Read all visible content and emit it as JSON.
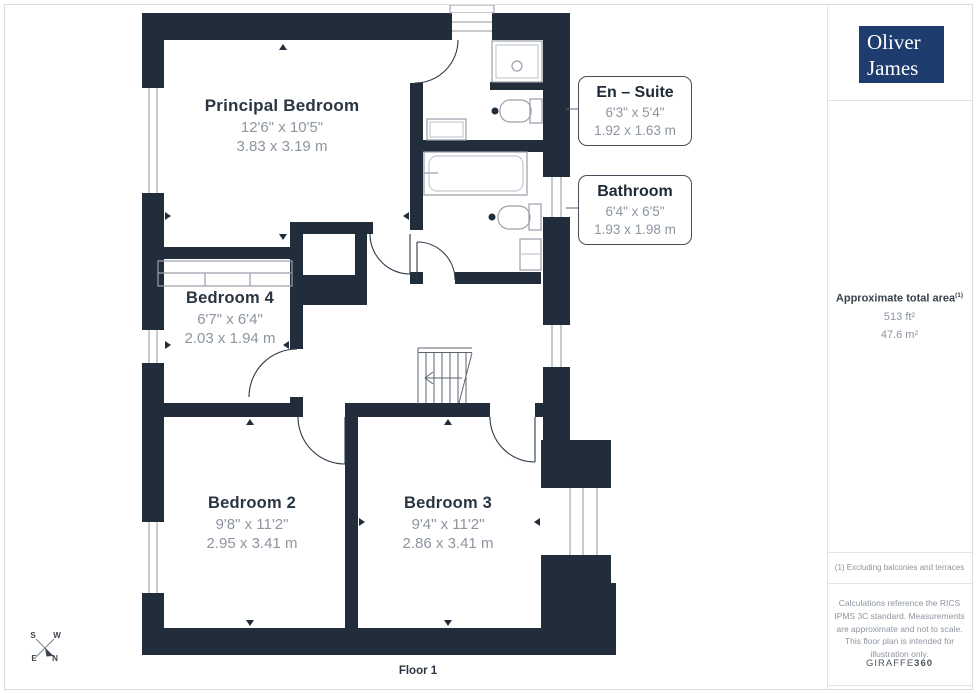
{
  "plan": {
    "floor_label": "Floor 1",
    "rooms": [
      {
        "name": "Principal Bedroom",
        "imperial": "12'6\" x 10'5\"",
        "metric": "3.83 x 3.19 m"
      },
      {
        "name": "Bedroom 4",
        "imperial": "6'7\" x 6'4\"",
        "metric": "2.03 x 1.94 m"
      },
      {
        "name": "Bedroom 2",
        "imperial": "9'8\" x 11'2\"",
        "metric": "2.95 x 3.41 m"
      },
      {
        "name": "Bedroom 3",
        "imperial": "9'4\" x 11'2\"",
        "metric": "2.86 x 3.41 m"
      }
    ],
    "callouts": [
      {
        "name": "En – Suite",
        "imperial": "6'3\" x 5'4\"",
        "metric": "1.92 x 1.63 m"
      },
      {
        "name": "Bathroom",
        "imperial": "6'4\" x 6'5\"",
        "metric": "1.93 x 1.98 m"
      }
    ],
    "compass": {
      "n": "N",
      "s": "S",
      "e": "E",
      "w": "W"
    }
  },
  "sidebar": {
    "logo_line1": "Oliver",
    "logo_line2": "James",
    "area_title": "Approximate total area",
    "area_sup": "(1)",
    "area_ft": "513 ft²",
    "area_m": "47.6 m²",
    "footnote": "(1) Excluding balconies and terraces",
    "disclaimer": "Calculations reference the RICS IPMS 3C standard. Measurements are approximate and not to scale. This floor plan is intended for illustration only.",
    "brand": "GIRAFFE",
    "brand_suffix": "360"
  },
  "colors": {
    "wall": "#212d3b",
    "logo_bg": "#1e3c6e",
    "title_text": "#2a3542",
    "dim_text": "#8d959f",
    "fixture_line": "#99a1aa",
    "divider_line": "#e4e4e4"
  }
}
